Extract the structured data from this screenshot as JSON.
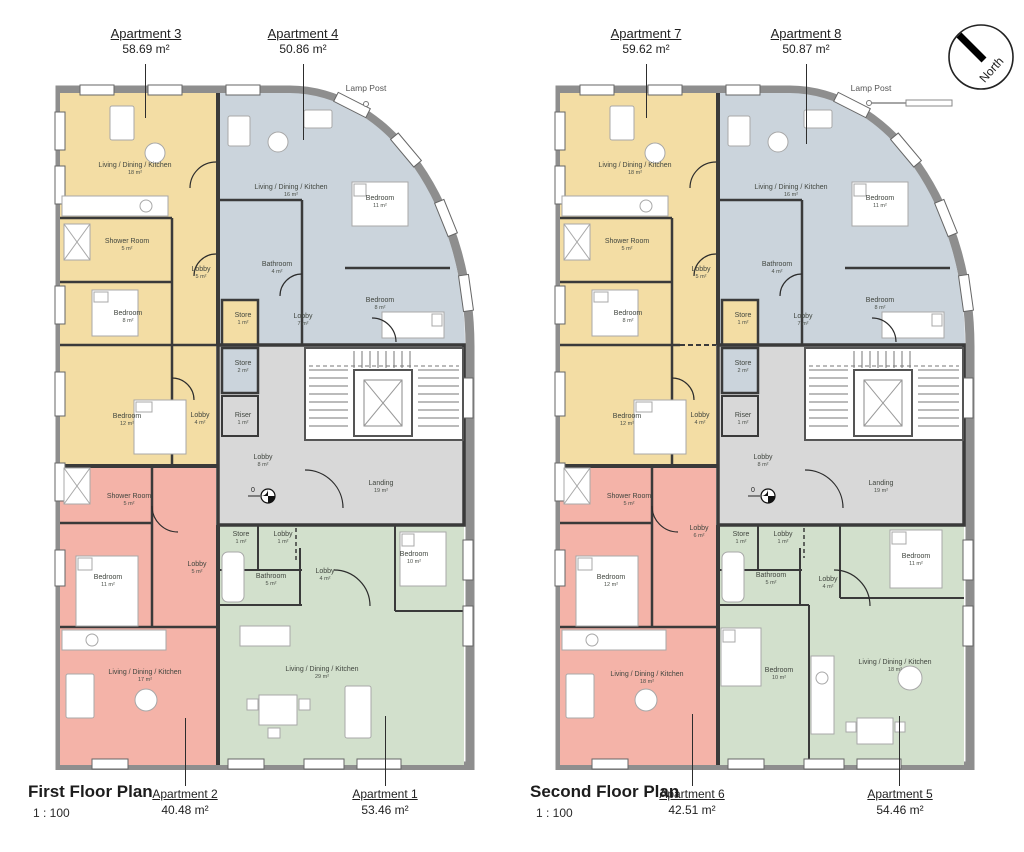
{
  "north": {
    "label": "North"
  },
  "floors": [
    {
      "title": "First Floor Plan",
      "scale": "1 : 100",
      "lamp_post": "Lamp Post",
      "benchmark": "0",
      "header_labels": [
        {
          "name": "Apartment 3",
          "area": "58.69 m²"
        },
        {
          "name": "Apartment 4",
          "area": "50.86 m²"
        }
      ],
      "footer_labels": [
        {
          "name": "Apartment 2",
          "area": "40.48 m²"
        },
        {
          "name": "Apartment 1",
          "area": "53.46 m²"
        }
      ],
      "rooms": {
        "a3_ldk": {
          "name": "Living / Dining / Kitchen",
          "area": "18 m²"
        },
        "a3_shower": {
          "name": "Shower Room",
          "area": "5 m²"
        },
        "a3_lobby": {
          "name": "Lobby",
          "area": "5 m²"
        },
        "a3_bed1": {
          "name": "Bedroom",
          "area": "8 m²"
        },
        "a3_store": {
          "name": "Store",
          "area": "1 m²"
        },
        "a3_bed2": {
          "name": "Bedroom",
          "area": "12 m²"
        },
        "a3_lobby2": {
          "name": "Lobby",
          "area": "4 m²"
        },
        "a4_ldk": {
          "name": "Living / Dining / Kitchen",
          "area": "16 m²"
        },
        "a4_bed1": {
          "name": "Bedroom",
          "area": "11 m²"
        },
        "a4_bath": {
          "name": "Bathroom",
          "area": "4 m²"
        },
        "a4_lobby": {
          "name": "Lobby",
          "area": "7 m²"
        },
        "a4_bed2": {
          "name": "Bedroom",
          "area": "8 m²"
        },
        "c_store": {
          "name": "Store",
          "area": "2 m²"
        },
        "c_riser": {
          "name": "Riser",
          "area": "1 m²"
        },
        "c_lobby": {
          "name": "Lobby",
          "area": "8 m²"
        },
        "c_landing": {
          "name": "Landing",
          "area": "19 m²"
        },
        "a2_shower": {
          "name": "Shower Room",
          "area": "5 m²"
        },
        "a2_bed": {
          "name": "Bedroom",
          "area": "11 m²"
        },
        "a2_lobby": {
          "name": "Lobby",
          "area": "5 m²"
        },
        "a2_ldk": {
          "name": "Living / Dining / Kitchen",
          "area": "17 m²"
        },
        "a1_store": {
          "name": "Store",
          "area": "1 m²"
        },
        "a1_lobby1": {
          "name": "Lobby",
          "area": "1 m²"
        },
        "a1_bath": {
          "name": "Bathroom",
          "area": "5 m²"
        },
        "a1_lobby2": {
          "name": "Lobby",
          "area": "4 m²"
        },
        "a1_bed": {
          "name": "Bedroom",
          "area": "10 m²"
        },
        "a1_ldk": {
          "name": "Living / Dining / Kitchen",
          "area": "29 m²"
        }
      }
    },
    {
      "title": "Second Floor Plan",
      "scale": "1 : 100",
      "lamp_post": "Lamp Post",
      "benchmark": "0",
      "header_labels": [
        {
          "name": "Apartment 7",
          "area": "59.62 m²"
        },
        {
          "name": "Apartment 8",
          "area": "50.87 m²"
        }
      ],
      "footer_labels": [
        {
          "name": "Apartment 6",
          "area": "42.51 m²"
        },
        {
          "name": "Apartment 5",
          "area": "54.46 m²"
        }
      ],
      "rooms": {
        "a7_ldk": {
          "name": "Living / Dining / Kitchen",
          "area": "18 m²"
        },
        "a7_shower": {
          "name": "Shower Room",
          "area": "5 m²"
        },
        "a7_lobby": {
          "name": "Lobby",
          "area": "5 m²"
        },
        "a7_bed1": {
          "name": "Bedroom",
          "area": "8 m²"
        },
        "a7_store": {
          "name": "Store",
          "area": "1 m²"
        },
        "a7_bed2": {
          "name": "Bedroom",
          "area": "12 m²"
        },
        "a7_lobby2": {
          "name": "Lobby",
          "area": "4 m²"
        },
        "a8_ldk": {
          "name": "Living / Dining / Kitchen",
          "area": "16 m²"
        },
        "a8_bed1": {
          "name": "Bedroom",
          "area": "11 m²"
        },
        "a8_bath": {
          "name": "Bathroom",
          "area": "4 m²"
        },
        "a8_lobby": {
          "name": "Lobby",
          "area": "7 m²"
        },
        "a8_bed2": {
          "name": "Bedroom",
          "area": "8 m²"
        },
        "c_store": {
          "name": "Store",
          "area": "2 m²"
        },
        "c_riser": {
          "name": "Riser",
          "area": "1 m²"
        },
        "c_lobby": {
          "name": "Lobby",
          "area": "8 m²"
        },
        "c_landing": {
          "name": "Landing",
          "area": "19 m²"
        },
        "a6_shower": {
          "name": "Shower Room",
          "area": "5 m²"
        },
        "a6_bed": {
          "name": "Bedroom",
          "area": "12 m²"
        },
        "a6_lobby": {
          "name": "Lobby",
          "area": "6 m²"
        },
        "a6_ldk": {
          "name": "Living / Dining / Kitchen",
          "area": "18 m²"
        },
        "a5_store": {
          "name": "Store",
          "area": "1 m²"
        },
        "a5_lobby1": {
          "name": "Lobby",
          "area": "1 m²"
        },
        "a5_bath": {
          "name": "Bathroom",
          "area": "5 m²"
        },
        "a5_lobby2": {
          "name": "Lobby",
          "area": "4 m²"
        },
        "a5_bed1": {
          "name": "Bedroom",
          "area": "11 m²"
        },
        "a5_bed2": {
          "name": "Bedroom",
          "area": "10 m²"
        },
        "a5_ldk": {
          "name": "Living / Dining / Kitchen",
          "area": "18 m²"
        }
      }
    }
  ]
}
